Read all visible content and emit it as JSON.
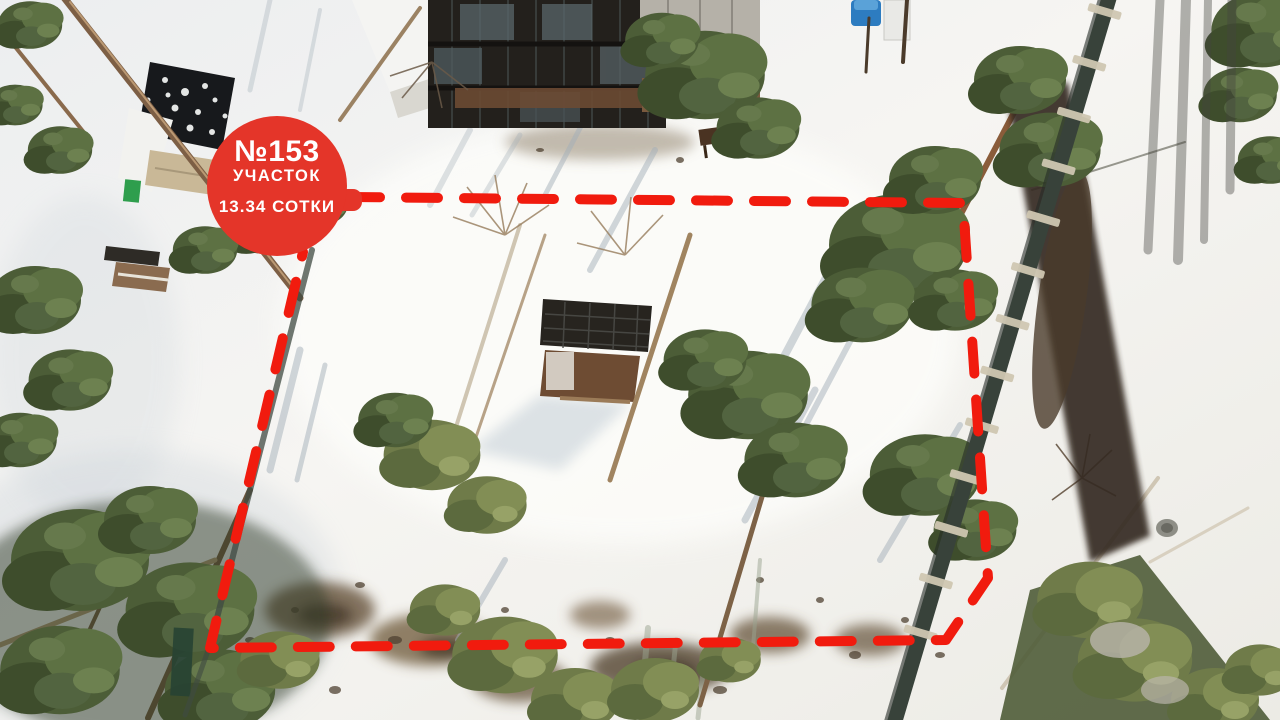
{
  "badge": {
    "plot_number": "№153",
    "plot_label": "УЧАСТОК",
    "area_label": "13.34 СОТКИ",
    "background_color": "#e43529",
    "text_color": "#ffffff"
  },
  "boundary": {
    "color": "#f11b0e",
    "style": "dashed"
  },
  "scene_colors": {
    "snow": "#f1f1ee",
    "pine_green": "#4c5d37",
    "olive_green": "#6f7b49",
    "bare_ground": "#6e5c44",
    "fence_dark": "#38423a",
    "water_tank_blue": "#2d7cc0"
  }
}
